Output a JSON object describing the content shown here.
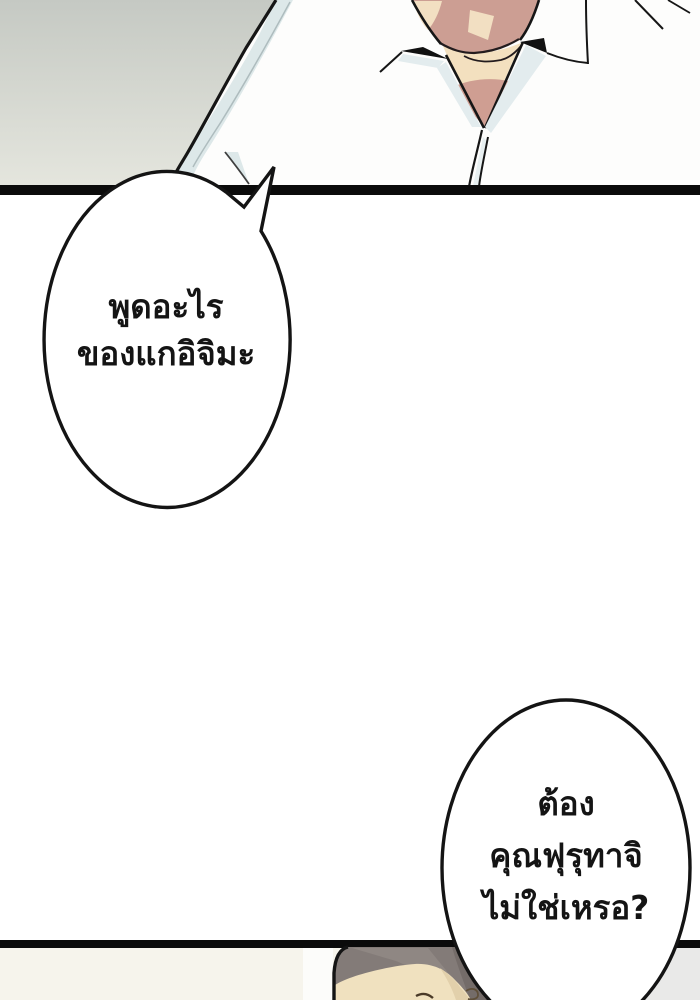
{
  "dialogue": {
    "bubble1": {
      "lines": [
        "พูดอะไร",
        "ของแกอิจิมะ"
      ]
    },
    "bubble2": {
      "lines": [
        "ต้อง",
        "คุณฟุรุทาจิ",
        "ไม่ใช่เหรอ?"
      ]
    }
  },
  "colors": {
    "page_background": "#ffffff",
    "top_panel_bg_top": "#c5c9c3",
    "top_panel_bg_bottom": "#e6e7df",
    "panel_divider": "#0b0b0b",
    "bubble_fill": "#ffffff",
    "bubble_stroke": "#141414",
    "dialogue_text": "#141414",
    "shirt": "#fdfdfc",
    "shirt_shading": "#dde8e9",
    "skin_chin": "#cc9e93",
    "skin_highlight": "#f2dfc2",
    "neck_light": "#f3e0bf",
    "neck_shadow": "#cf9e92",
    "collar_gap_shadow": "#111111",
    "hair": "#837b78",
    "hair_dark": "#746c69",
    "hair_highlight": "#8f8783",
    "forehead_skin": "#f0e1bf",
    "bottom_panel_bg": "#f6f4ec",
    "bottom_panel_right_shade": "#e9e9e8"
  }
}
